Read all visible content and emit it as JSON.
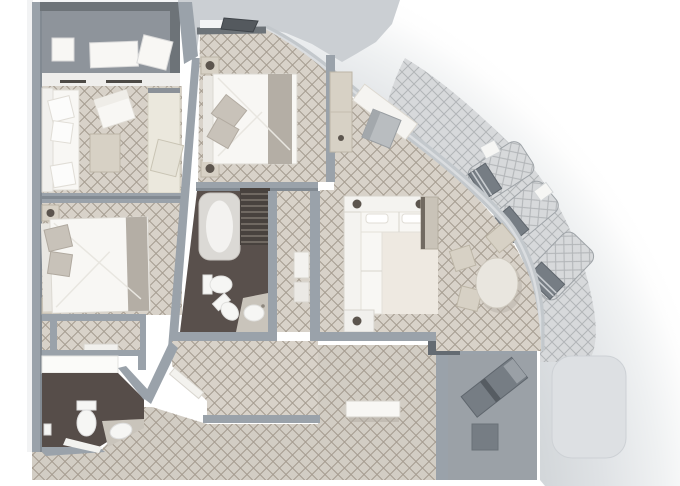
{
  "scene_label": "suite-floor-plan",
  "colors": {
    "page_bg": "#ffffff",
    "wall": "#9aa2aa",
    "wall_dark": "#6d7378",
    "wall_shade": "#828a92",
    "carpet_bg": "#d8d2c9",
    "carpet_line": "#a69d91",
    "corridor_bg": "#d2cdc4",
    "corridor_line": "#a59c90",
    "veranda_bg": "#d7d9db",
    "veranda_line": "#b2b5b8",
    "deck_gray": "#cbcfd3",
    "balcony_floor": "#8e949b",
    "terrace_floor": "#9ba1a7",
    "bath_floor": "#564d49",
    "bath_floor2": "#59504c",
    "window_band": "#efeeec",
    "window_tick": "#4d4a46",
    "window_wall": "#c3c8cc",
    "window_wall_hi": "#dadde0",
    "furniture_white": "#f8f7f4",
    "furniture_white_stroke": "#dcd9d2",
    "furniture_beige": "#d7d1c5",
    "furniture_beige_stroke": "#bcb5a6",
    "pillow_gray": "#c8c2b9",
    "bed_runner": "#b4aea5",
    "knob_dark": "#5c554e",
    "lounger_dark": "#767d84",
    "lounger_light": "#c2c6c9",
    "lounger_stroke": "#5f666d",
    "chair_gray": "#b9bdc0",
    "tv_front": "#716a61",
    "shower_floor": "#48423e",
    "shower_stripe": "#7d766f",
    "spa_fill": "#dde0e3",
    "spa_stroke": "#cdd1d5",
    "step_dark": "#646b72",
    "rug": "#eee9e1",
    "fixture_white": "#f6f6f4",
    "counter_gray": "#c9c4bb",
    "rim_0": "#cfd3d6",
    "rim_1": "#d3d7da",
    "rim_2": "#dfe2e5",
    "rim_3": "#eff1f2",
    "rim_4": "#fdfdfd",
    "rim_5": "#ffffff"
  },
  "rooms": [
    {
      "id": "forward-balcony",
      "label": "forward balcony"
    },
    {
      "id": "sitting-room",
      "label": "sitting room"
    },
    {
      "id": "second-bedroom",
      "label": "second bedroom"
    },
    {
      "id": "vestibule",
      "label": "vestibule"
    },
    {
      "id": "second-bathroom",
      "label": "second bathroom"
    },
    {
      "id": "master-bedroom",
      "label": "master bedroom"
    },
    {
      "id": "master-bathroom",
      "label": "master bathroom"
    },
    {
      "id": "closet-nook",
      "label": "closet nook"
    },
    {
      "id": "living-dining-room",
      "label": "living and dining room"
    },
    {
      "id": "entry-hall",
      "label": "entry hall"
    },
    {
      "id": "wraparound-veranda",
      "label": "wrap-around veranda"
    },
    {
      "id": "aft-terrace",
      "label": "aft terrace"
    },
    {
      "id": "corridor",
      "label": "corridor"
    }
  ],
  "furniture": [
    "double-bed",
    "nightstand",
    "table-lamp",
    "sofa",
    "chaise-sofa",
    "armchair",
    "ottoman",
    "vanity-desk",
    "desk-chair",
    "l-shaped-sofa",
    "end-table",
    "tv-cabinet",
    "dining-table",
    "dining-chair",
    "wardrobe",
    "shelf-unit",
    "bathtub",
    "shower",
    "toilet",
    "bidet",
    "sink",
    "vanity-counter",
    "sun-lounger",
    "side-table",
    "lounge-chair",
    "cube-table",
    "bench",
    "spa-tub",
    "balcony-table",
    "balcony-lounger",
    "light-switch",
    "entry-door"
  ]
}
